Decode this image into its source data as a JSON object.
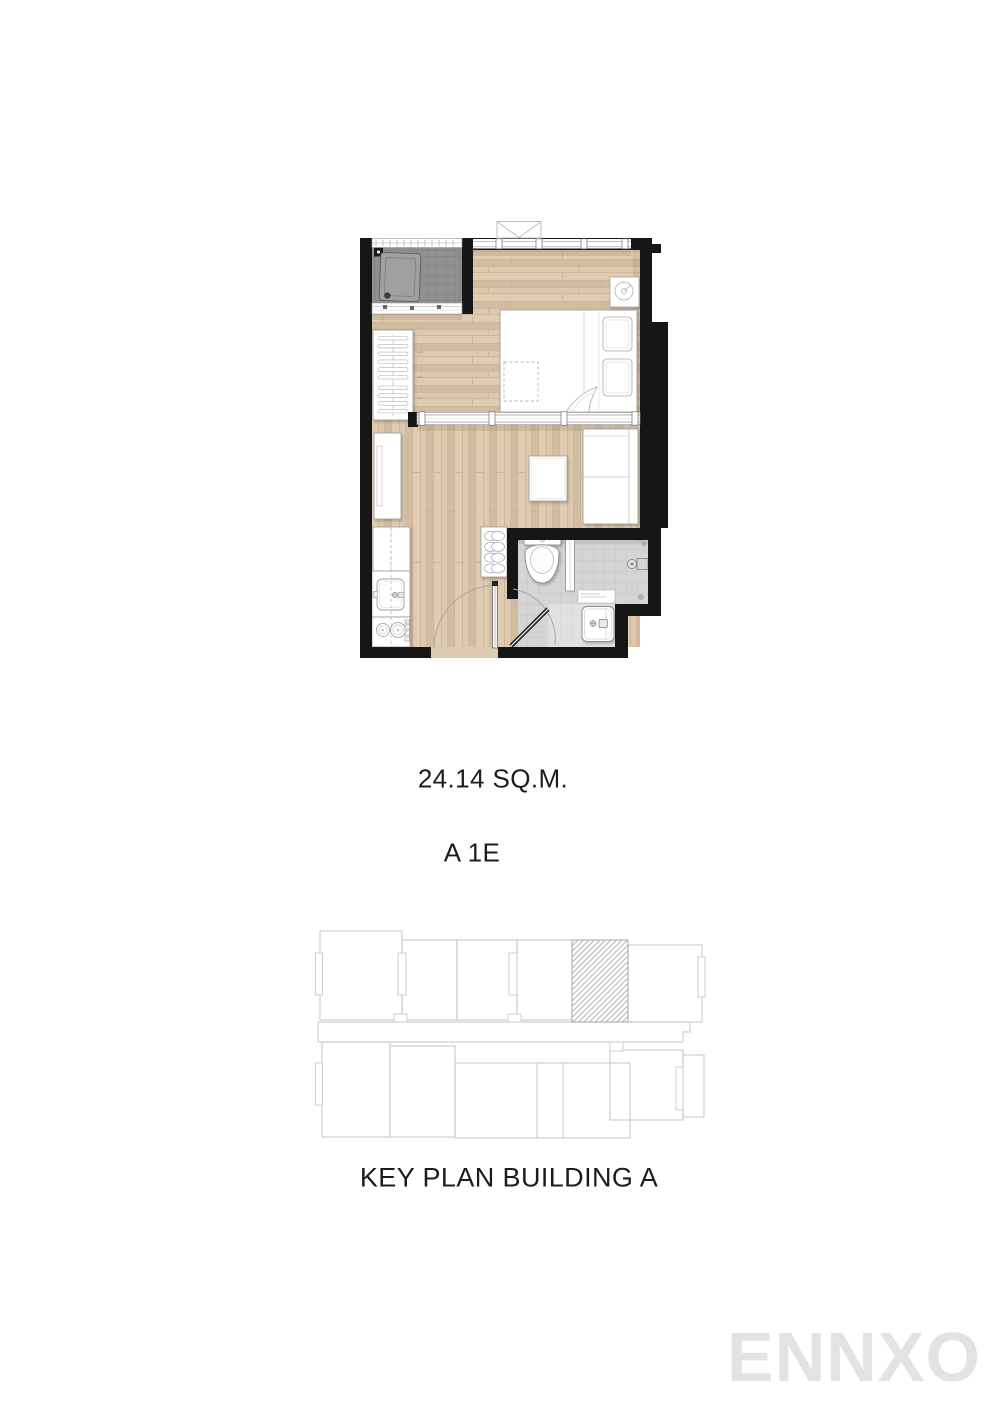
{
  "page": {
    "background": "#ffffff"
  },
  "floor_plan": {
    "area_label": "24.14 SQ.M.",
    "unit_label": "A 1E",
    "features": [
      "balcony-with-ac-compressor",
      "bedroom-with-double-bed",
      "wardrobe",
      "living-area-with-sofa-and-tv-console",
      "kitchenette-with-sink-and-two-burner-stove",
      "bathroom-with-toilet-shower-and-basin",
      "entrance-door"
    ]
  },
  "key_plan": {
    "title": "KEY PLAN BUILDING A",
    "highlighted_unit_style": "diagonal-hatch"
  },
  "watermark": {
    "text": "ENNXO"
  },
  "colors": {
    "wall": "#161616",
    "wood_floor": "#dac6ab",
    "balcony_tile": "#909090",
    "bathroom_tile": "#d5d5d5",
    "furniture_line": "#a5a5a5",
    "key_plan_line": "#cfcfcf",
    "text": "#1c1c1c",
    "watermark": "#e3e3e3"
  }
}
